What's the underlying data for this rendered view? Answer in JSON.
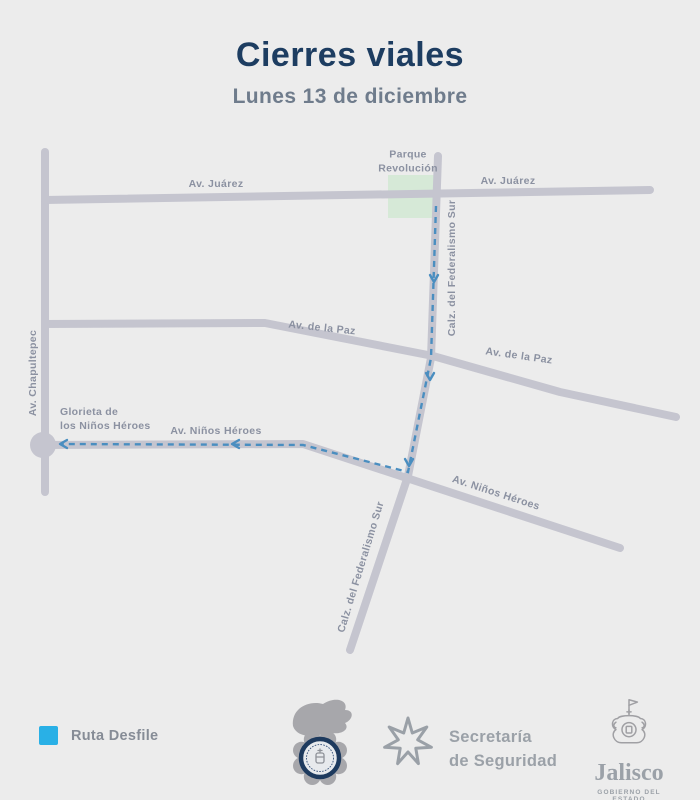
{
  "header": {
    "title": "Cierres viales",
    "subtitle": "Lunes 13 de diciembre"
  },
  "map": {
    "streets": {
      "juarez_left": "Av. Juárez",
      "juarez_right": "Av. Juárez",
      "paz_left": "Av. de la Paz",
      "paz_right": "Av. de la Paz",
      "chapultepec": "Av. Chapultepec",
      "federalismo_upper": "Calz. del Federalismo Sur",
      "federalismo_lower": "Calz. del Federalismo Sur",
      "ninos_heroes_west": "Av. Niños Héroes",
      "ninos_heroes_southeast": "Av. Niños Héroes"
    },
    "places": {
      "parque_line1": "Parque",
      "parque_line2": "Revolución",
      "glorieta_line1": "Glorieta de",
      "glorieta_line2": "los Niños Héroes"
    },
    "route": {
      "name": "Ruta Desfile",
      "direction": "south on Calz. del Federalismo Sur, then west on Av. Niños Héroes to Glorieta de los Niños Héroes"
    },
    "colors": {
      "background": "#ececec",
      "road": "#c5c5cf",
      "park": "#d6e9d7",
      "route": "#4a8ec0",
      "street_label": "#8b91a1",
      "title": "#1d3d61",
      "subtitle": "#6f7c8c",
      "legend_swatch": "#29b0e6",
      "legend_label": "#868c96",
      "logo_gray": "#9ba1a8",
      "badge_navy": "#1d3a5e"
    }
  },
  "legend": {
    "route_label": "Ruta Desfile"
  },
  "footer": {
    "secretaria_line1": "Secretaría",
    "secretaria_line2": "de Seguridad",
    "jalisco_label": "Jalisco",
    "gobierno_label": "GOBIERNO DEL ESTADO"
  }
}
